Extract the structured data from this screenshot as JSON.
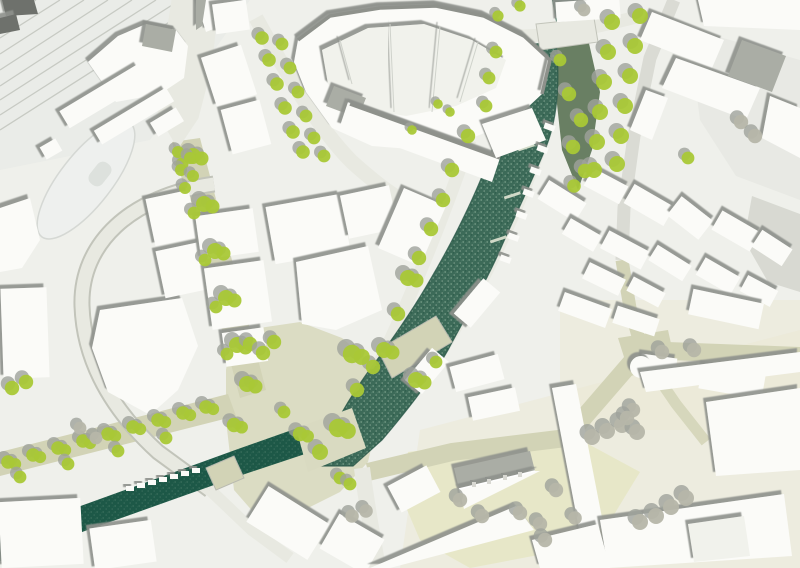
{
  "meta": {
    "type": "urban-design-masterplan",
    "view": "aerial-site-plan-render",
    "description_tags": [
      "river-corridor",
      "historic-town-center",
      "railway-station",
      "tree-lined-streets",
      "canal",
      "pedestrian-bridges"
    ]
  },
  "palette": {
    "base": "#eff0eb",
    "rail_ground": "#eaece8",
    "track": "#c7cac3",
    "building": "#fbfbf8",
    "platform": "#e3e5df",
    "roof_gray": "#aaada5",
    "dark_roof": "#6e716c",
    "water_river": "#3c6a58",
    "water_canal": "#1d5847",
    "water_edge": "#2b5748",
    "bank_veg": "#697f63",
    "bank_olive": "#c9cbaa",
    "road_khaki": "#d2d3b6",
    "road_light": "#e8e9e1",
    "road_gray": "#dadbd4",
    "curb": "#c2c4ba",
    "plaza": "#d9dac1",
    "beige": "#ebe7d4",
    "park": "#e7e7c6",
    "tree_green": "#a9c836",
    "tree_gray": "#b6b6a9",
    "tree_shadow": "#9fa29b",
    "teardrop": "#eef0ee",
    "pond": "#dde1dd"
  },
  "scene": {
    "features": [
      {
        "name": "railway-tracks",
        "area": "top-left"
      },
      {
        "name": "station-buildings",
        "area": "top-left"
      },
      {
        "name": "bus-loop-island",
        "area": "mid-left"
      },
      {
        "name": "main-river",
        "area": "center, flowing top to bottom-left"
      },
      {
        "name": "canal",
        "area": "bottom-left"
      },
      {
        "name": "pedestrian-bridge",
        "area": "center"
      },
      {
        "name": "canal-bridge",
        "area": "bottom-left"
      },
      {
        "name": "street-trees",
        "area": "along streets both banks"
      },
      {
        "name": "perimeter-block",
        "area": "top-center"
      },
      {
        "name": "old-town-blocks",
        "area": "center-right"
      },
      {
        "name": "pitched-roof-landmark",
        "area": "bottom-center"
      },
      {
        "name": "plaza-with-tree-rows",
        "area": "bottom-right"
      }
    ]
  }
}
